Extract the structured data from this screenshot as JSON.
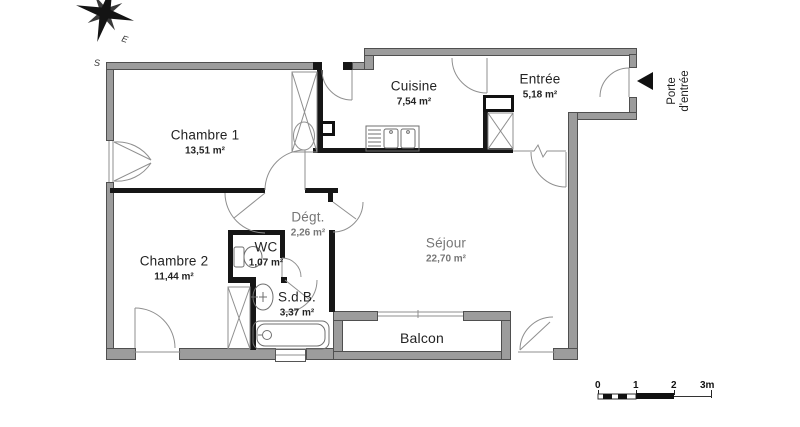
{
  "rooms": [
    {
      "name": "Chambre 1",
      "area": "13,51 m²"
    },
    {
      "name": "Cuisine",
      "area": "7,54 m²"
    },
    {
      "name": "Entrée",
      "area": "5,18 m²"
    },
    {
      "name": "Chambre 2",
      "area": "11,44 m²"
    },
    {
      "name": "Dégt.",
      "area": "2,26 m²"
    },
    {
      "name": "WC",
      "area": "1,07 m²"
    },
    {
      "name": "S.d.B.",
      "area": "3,37 m²"
    },
    {
      "name": "Séjour",
      "area": "22,70 m²"
    },
    {
      "name": "Balcon",
      "area": ""
    }
  ],
  "porte": {
    "line1": "Porte",
    "line2": "d'entrée"
  },
  "compass": {
    "s": "S",
    "e": "E"
  },
  "scale": {
    "t0": "0",
    "t1": "1",
    "t2": "2",
    "t3": "3m"
  },
  "colors": {
    "exterior_wall": "#9c9c9c",
    "interior_wall": "#161616",
    "line": "#8a8a8a",
    "background": "#ffffff"
  }
}
